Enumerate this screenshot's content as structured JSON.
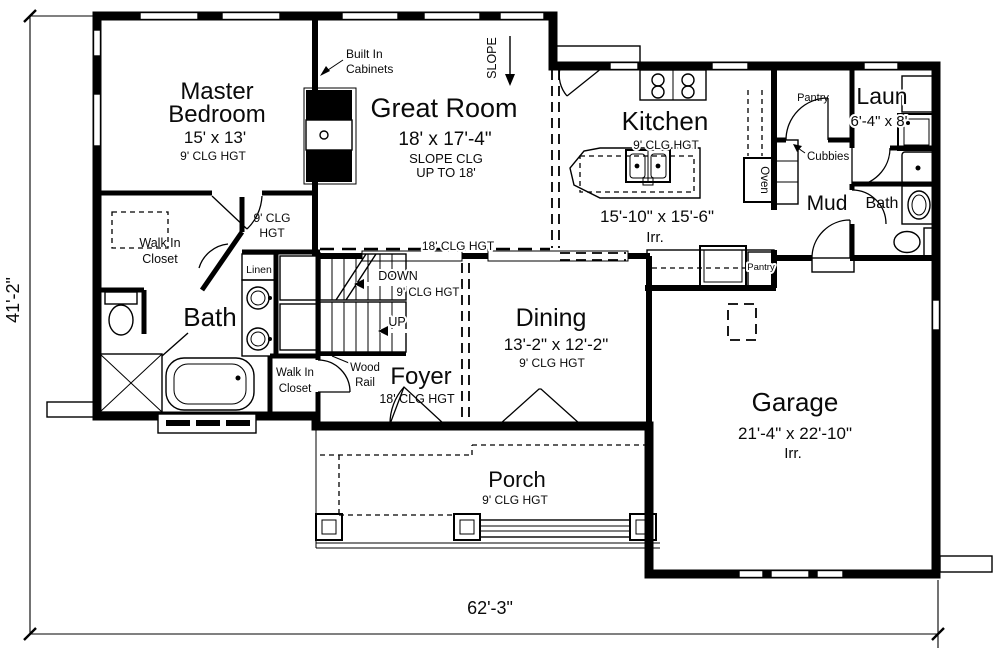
{
  "dimensions": {
    "left": "41'-2\"",
    "bottom": "62'-3\""
  },
  "rooms": {
    "master_bedroom": {
      "name1": "Master",
      "name2": "Bedroom",
      "size": "15' x 13'",
      "ceiling": "9' CLG HGT"
    },
    "great_room": {
      "name": "Great Room",
      "size": "18' x 17'-4\"",
      "ceiling1": "SLOPE CLG",
      "ceiling2": "UP TO 18'"
    },
    "kitchen": {
      "name": "Kitchen",
      "ceiling": "9' CLG HGT",
      "size": "15'-10\" x 15'-6\"",
      "irr": "Irr."
    },
    "dining": {
      "name": "Dining",
      "size": "13'-2\" x 12'-2\"",
      "ceiling": "9' CLG HGT"
    },
    "foyer": {
      "name": "Foyer",
      "ceiling": "18' CLG HGT"
    },
    "garage": {
      "name": "Garage",
      "size": "21'-4\" x 22'-10\"",
      "irr": "Irr."
    },
    "porch": {
      "name": "Porch",
      "ceiling": "9' CLG HGT"
    },
    "laundry": {
      "name": "Laun",
      "size": "6'-4\" x 8'"
    },
    "mud": {
      "name": "Mud"
    },
    "hall_bath": {
      "name": "Bath"
    },
    "master_bath": {
      "name": "Bath"
    },
    "master_closet": {
      "line1": "Walk In",
      "line2": "Closet"
    },
    "foyer_closet": {
      "line1": "Walk In",
      "line2": "Closet"
    }
  },
  "annotations": {
    "built_in1": "Built In",
    "built_in2": "Cabinets",
    "slope": "SLOPE",
    "hall_clg1": "9' CLG",
    "hall_clg2": "HGT",
    "edge_clg": "18' CLG HGT",
    "stairs_down": "DOWN",
    "stairs_clg": "9' CLG HGT",
    "stairs_up": "UP",
    "wood_rail1": "Wood",
    "wood_rail2": "Rail",
    "linen": "Linen",
    "pantry_top": "Pantry",
    "pantry_lower": "Pantry",
    "cubbies": "Cubbies",
    "oven": "Oven"
  },
  "colors": {
    "line": "#000000",
    "background": "#ffffff"
  }
}
